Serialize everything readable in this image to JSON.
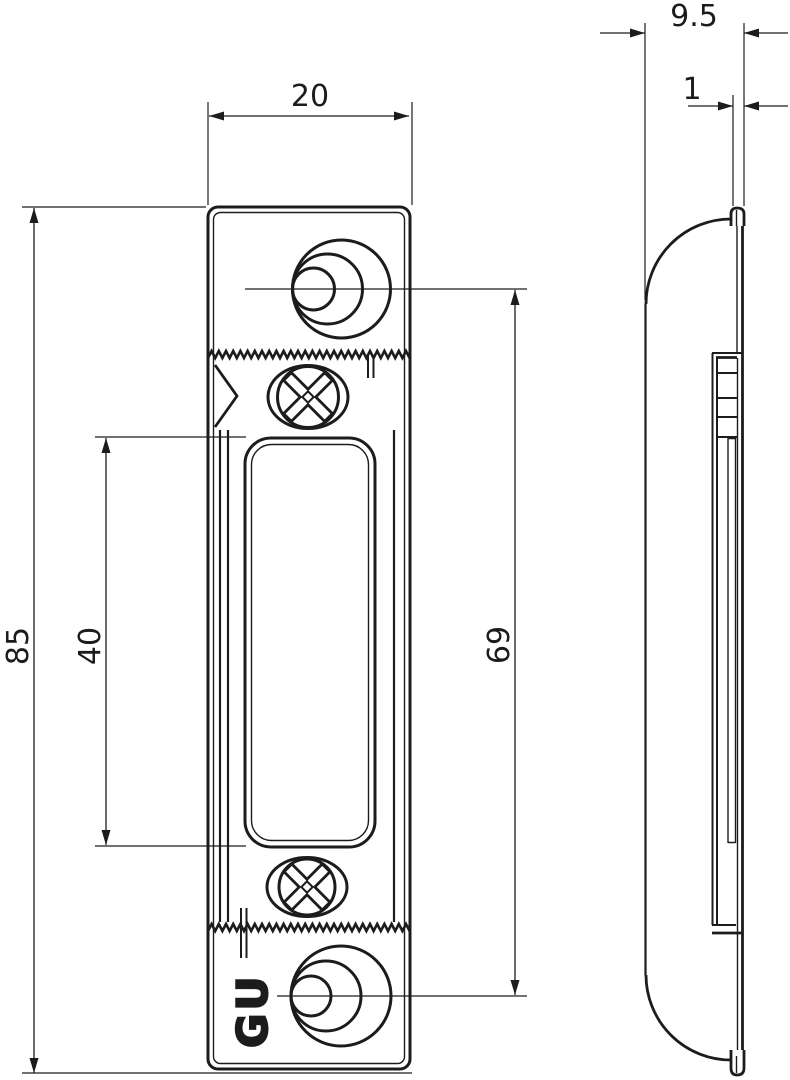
{
  "drawing": {
    "line_color": "#1c1c1c",
    "background_color": "#ffffff",
    "dimensions": {
      "plate_width": "20",
      "side_depth": "9.5",
      "plate_thickness": "1",
      "plate_height": "85",
      "slot_height": "40",
      "hole_spacing": "69"
    },
    "logo": "GU"
  }
}
